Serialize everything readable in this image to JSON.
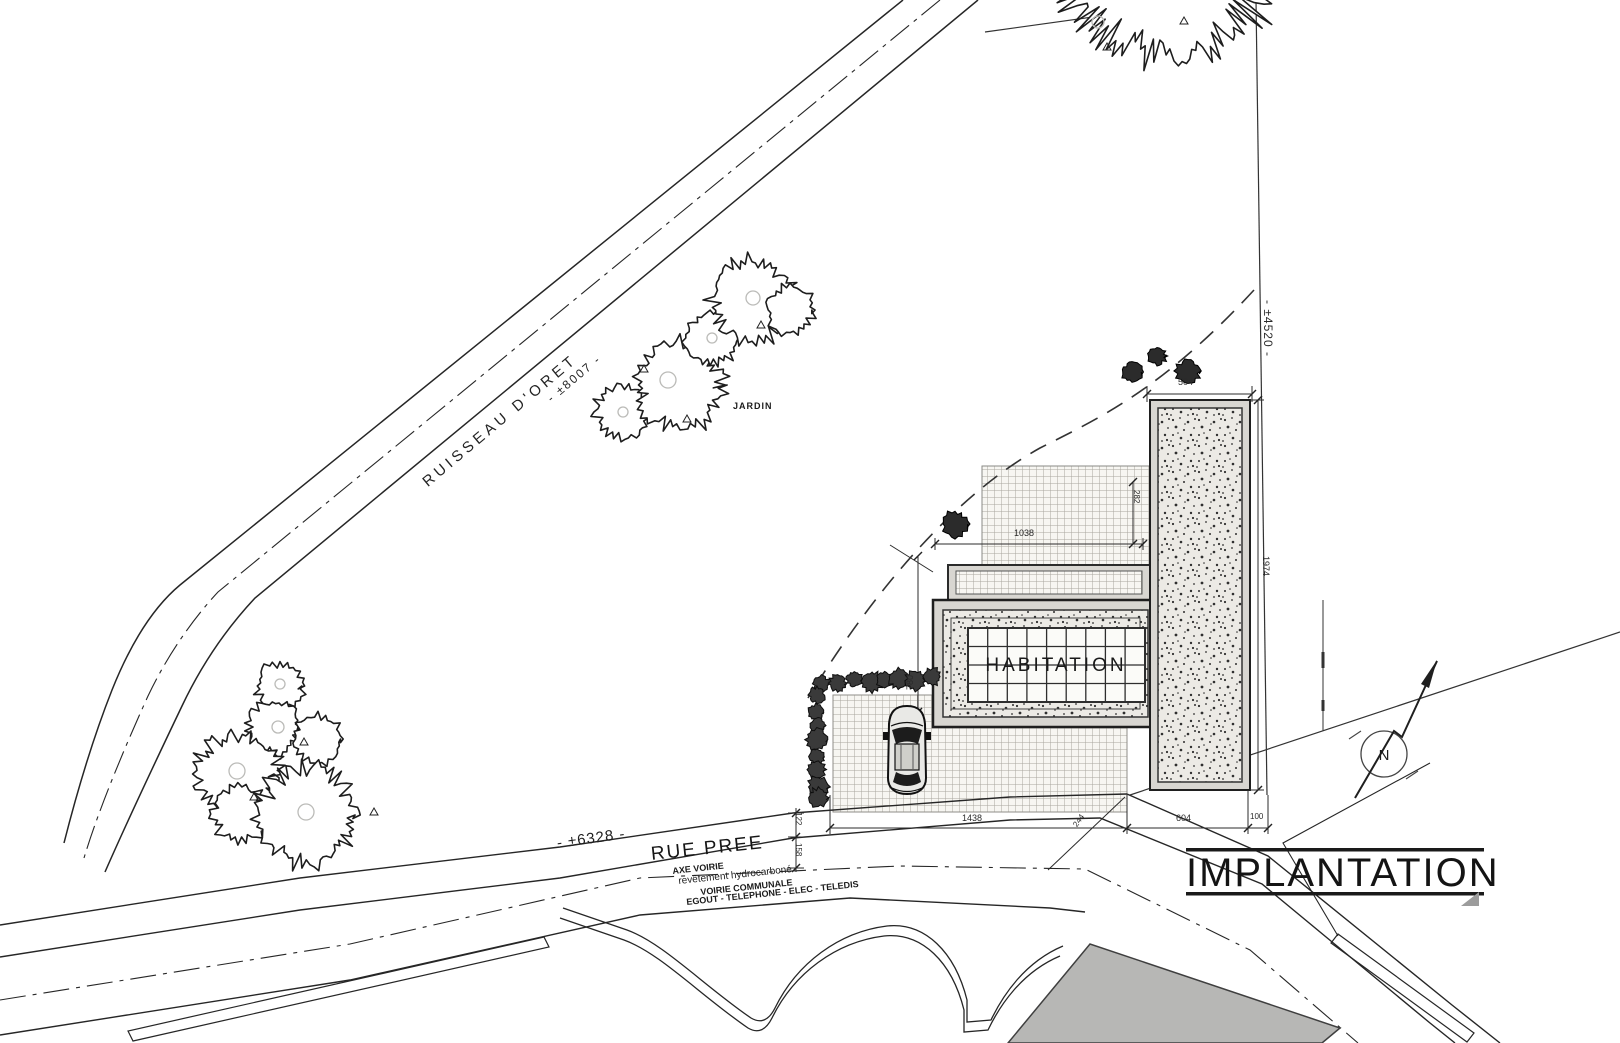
{
  "plan": {
    "title": "IMPLANTATION",
    "building_label": "HABITATION",
    "garden_label": "JARDIN",
    "north_label": "N",
    "stream": {
      "name": "RUISSEAU D'ORET",
      "length_dim": "- ±8007 -"
    },
    "boundaries": {
      "east_dim": "- ±4520 -",
      "south_dim": "- ±6328 -"
    },
    "street": {
      "name": "RUE PREE",
      "axis": "AXE VOIRIE",
      "surface": "revêtement hydrocarboné",
      "type": "VOIRIE COMMUNALE",
      "utilities": "EGOUT - TELEPHONE - ELEC - TELEDIS"
    },
    "dims": {
      "terrace_width": "504",
      "terrace_depth": "1974",
      "upper_terrace": "282",
      "house_width": "1038",
      "house_depth": "780",
      "front_left": "1438",
      "front_diag": "244",
      "front_right": "604",
      "front_margin": "100",
      "verge_upper": "122",
      "verge_lower": "158"
    }
  }
}
